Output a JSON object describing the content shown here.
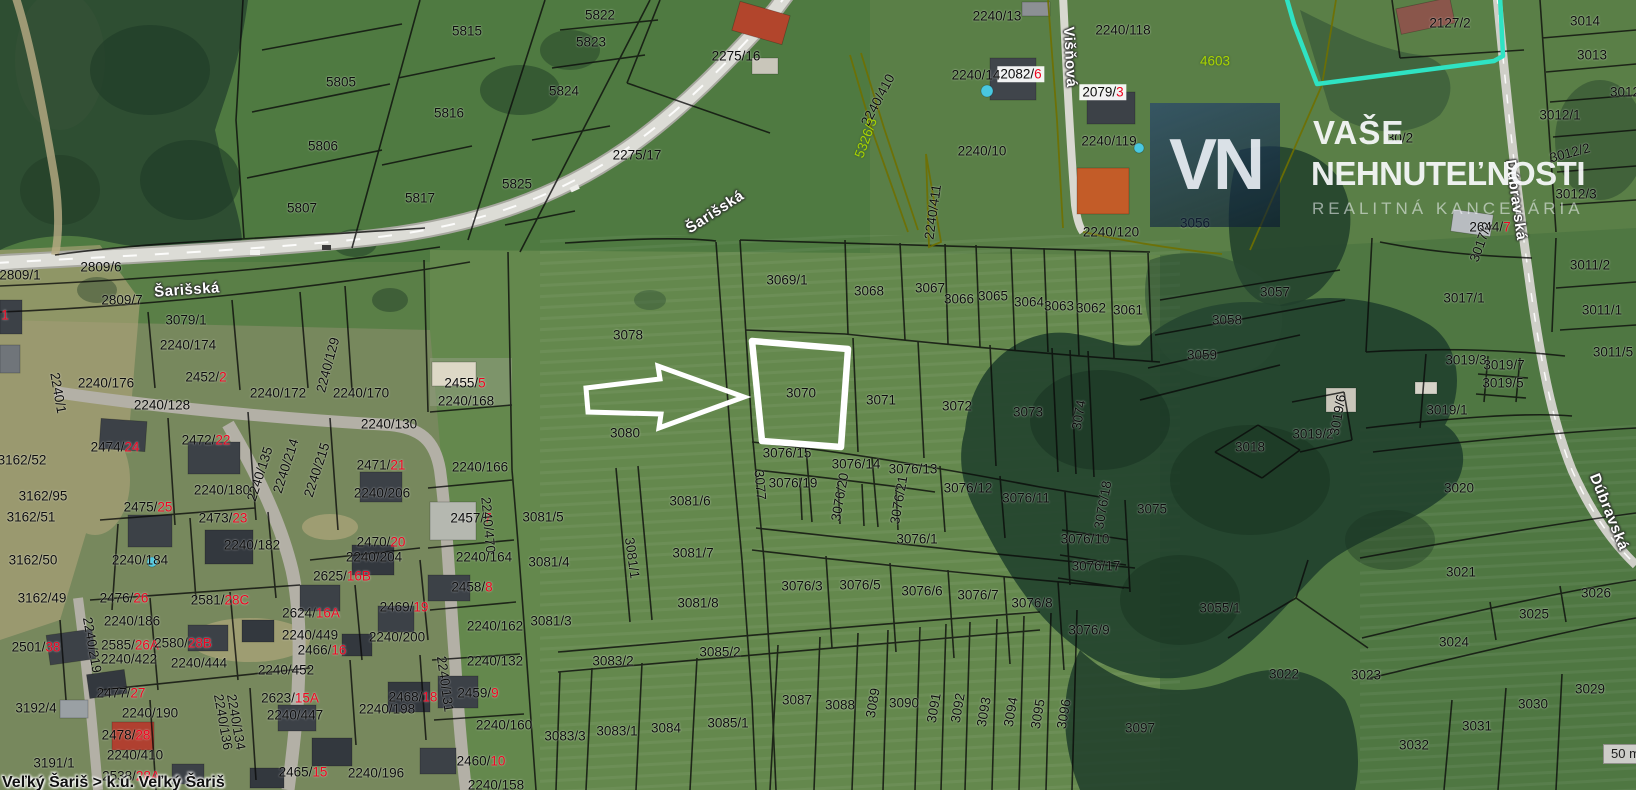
{
  "map": {
    "highlighted_parcel": "3070",
    "scale_label": "50 m",
    "status_text": "Veľký Šariš > k.ú. Veľký Šariš",
    "watermark": {
      "initials": "VN",
      "line1": "VAŠE",
      "line2": "NEHNUTEĽNOSTI",
      "line3": "REALITNÁ KANCELÁRIA"
    },
    "colors": {
      "red_suffix": "#ef0420",
      "yellow_label": "#a9d400",
      "cyan_boundary": "#2fe3c3",
      "highlight_outline": "#ffffff",
      "field_green": "#5a7f47"
    },
    "streets": [
      {
        "name": "Šarišská",
        "x": 715,
        "y": 212,
        "a": -33
      },
      {
        "name": "Šarišská",
        "x": 187,
        "y": 290,
        "a": -4
      },
      {
        "name": "Višňová",
        "x": 1070,
        "y": 57,
        "a": 87
      },
      {
        "name": "Dúbravská",
        "x": 1516,
        "y": 200,
        "a": 82
      },
      {
        "name": "Dúbravská",
        "x": 1609,
        "y": 512,
        "a": 68
      }
    ],
    "parcel_labels": [
      {
        "t": "5805",
        "x": 341,
        "y": 82
      },
      {
        "t": "5806",
        "x": 323,
        "y": 146
      },
      {
        "t": "5807",
        "x": 302,
        "y": 208
      },
      {
        "t": "5815",
        "x": 467,
        "y": 31
      },
      {
        "t": "5816",
        "x": 449,
        "y": 113
      },
      {
        "t": "5817",
        "x": 420,
        "y": 198
      },
      {
        "t": "5822",
        "x": 600,
        "y": 15
      },
      {
        "t": "5823",
        "x": 591,
        "y": 42
      },
      {
        "t": "5824",
        "x": 564,
        "y": 91
      },
      {
        "t": "5825",
        "x": 517,
        "y": 184
      },
      {
        "t": "2275/16",
        "x": 736,
        "y": 56
      },
      {
        "t": "2275/17",
        "x": 637,
        "y": 155
      },
      {
        "t": "2240/13",
        "x": 997,
        "y": 16
      },
      {
        "t": "2240/118",
        "x": 1123,
        "y": 30
      },
      {
        "t": "2082/",
        "r": "6",
        "x": 1021,
        "y": 74,
        "w": true
      },
      {
        "t": "2079/",
        "r": "3",
        "x": 1103,
        "y": 92,
        "w": true
      },
      {
        "t": "2240/14",
        "x": 976,
        "y": 75
      },
      {
        "t": "4603",
        "x": 1215,
        "y": 61,
        "c": "y"
      },
      {
        "t": "2240/119",
        "x": 1109,
        "y": 141
      },
      {
        "t": "2240/120",
        "x": 1111,
        "y": 232
      },
      {
        "t": "2240/10",
        "x": 982,
        "y": 151
      },
      {
        "t": "2240/410",
        "x": 878,
        "y": 100,
        "a": -62
      },
      {
        "t": "5326/3",
        "x": 866,
        "y": 138,
        "a": -70,
        "c": "y"
      },
      {
        "t": "2240/411",
        "x": 933,
        "y": 212,
        "a": -82
      },
      {
        "t": "2127/2",
        "x": 1450,
        "y": 23
      },
      {
        "t": "30/2",
        "x": 1400,
        "y": 138
      },
      {
        "t": "3014",
        "x": 1585,
        "y": 21
      },
      {
        "t": "3013",
        "x": 1592,
        "y": 55
      },
      {
        "t": "3012",
        "x": 1625,
        "y": 92
      },
      {
        "t": "3012/1",
        "x": 1560,
        "y": 115
      },
      {
        "t": "3012/2",
        "x": 1570,
        "y": 153,
        "a": -15
      },
      {
        "t": "3012/3",
        "x": 1576,
        "y": 194
      },
      {
        "t": "2644/",
        "r": "7",
        "x": 1490,
        "y": 227
      },
      {
        "t": "3056",
        "x": 1195,
        "y": 223
      },
      {
        "t": "3057",
        "x": 1275,
        "y": 292
      },
      {
        "t": "3058",
        "x": 1227,
        "y": 320
      },
      {
        "t": "3059",
        "x": 1202,
        "y": 355
      },
      {
        "t": "2809/6",
        "x": 101,
        "y": 267
      },
      {
        "t": "2809/1",
        "x": 20,
        "y": 275
      },
      {
        "t": "2809/7",
        "x": 122,
        "y": 300
      },
      {
        "t": "3079/1",
        "x": 186,
        "y": 320
      },
      {
        "t": "2240/174",
        "x": 188,
        "y": 345
      },
      {
        "t": "",
        "r": "1",
        "x": 5,
        "y": 315
      },
      {
        "t": "2452/",
        "r": "2",
        "x": 206,
        "y": 377
      },
      {
        "t": "2240/176",
        "x": 106,
        "y": 383
      },
      {
        "t": "2240/129",
        "x": 328,
        "y": 365,
        "a": -75
      },
      {
        "t": "2240/172",
        "x": 278,
        "y": 393
      },
      {
        "t": "2240/170",
        "x": 361,
        "y": 393
      },
      {
        "t": "2240/128",
        "x": 162,
        "y": 405
      },
      {
        "t": "2240/1",
        "x": 58,
        "y": 393,
        "a": 80
      },
      {
        "t": "2240/130",
        "x": 389,
        "y": 424
      },
      {
        "t": "2455/",
        "r": "5",
        "x": 465,
        "y": 383
      },
      {
        "t": "2240/168",
        "x": 466,
        "y": 401
      },
      {
        "t": "2240/166",
        "x": 480,
        "y": 467
      },
      {
        "t": "2471/",
        "r": "21",
        "x": 381,
        "y": 465
      },
      {
        "t": "2240/206",
        "x": 382,
        "y": 493
      },
      {
        "t": "2457/",
        "r": "7",
        "x": 471,
        "y": 518
      },
      {
        "t": "3081/5",
        "x": 543,
        "y": 517
      },
      {
        "t": "2240/470",
        "x": 488,
        "y": 525,
        "a": 85
      },
      {
        "t": "2470/",
        "r": "20",
        "x": 381,
        "y": 542
      },
      {
        "t": "2240/204",
        "x": 374,
        "y": 557
      },
      {
        "t": "2240/164",
        "x": 484,
        "y": 557
      },
      {
        "t": "3081/4",
        "x": 549,
        "y": 562
      },
      {
        "t": "2625/",
        "r": "16B",
        "x": 342,
        "y": 576
      },
      {
        "t": "2474/",
        "r": "24",
        "x": 115,
        "y": 447
      },
      {
        "t": "2472/",
        "r": "22",
        "x": 206,
        "y": 440
      },
      {
        "t": "3162/52",
        "x": 22,
        "y": 460
      },
      {
        "t": "3162/95",
        "x": 43,
        "y": 496
      },
      {
        "t": "3162/51",
        "x": 31,
        "y": 517
      },
      {
        "t": "2240/180",
        "x": 222,
        "y": 490
      },
      {
        "t": "2240/135",
        "x": 260,
        "y": 474,
        "a": -72
      },
      {
        "t": "2240/214",
        "x": 286,
        "y": 466,
        "a": -72
      },
      {
        "t": "2240/215",
        "x": 317,
        "y": 470,
        "a": -72
      },
      {
        "t": "2475/",
        "r": "25",
        "x": 148,
        "y": 507
      },
      {
        "t": "2473/",
        "r": "23",
        "x": 223,
        "y": 518
      },
      {
        "t": "2240/182",
        "x": 252,
        "y": 545
      },
      {
        "t": "3162/50",
        "x": 33,
        "y": 560
      },
      {
        "t": "2240/184",
        "x": 140,
        "y": 560
      },
      {
        "t": "3162/49",
        "x": 42,
        "y": 598
      },
      {
        "t": "2476/",
        "r": "26",
        "x": 124,
        "y": 598
      },
      {
        "t": "2581/",
        "r": "28C",
        "x": 220,
        "y": 600
      },
      {
        "t": "2624/",
        "r": "16A",
        "x": 311,
        "y": 613
      },
      {
        "t": "2240/186",
        "x": 132,
        "y": 621
      },
      {
        "t": "2501/",
        "r": "38",
        "x": 36,
        "y": 647
      },
      {
        "t": "2585/",
        "r": "26A",
        "x": 130,
        "y": 645
      },
      {
        "t": "2580/",
        "r": "28B",
        "x": 183,
        "y": 643
      },
      {
        "t": "2240/422",
        "x": 129,
        "y": 659
      },
      {
        "t": "2240/444",
        "x": 199,
        "y": 663
      },
      {
        "t": "2240/449",
        "x": 310,
        "y": 635
      },
      {
        "t": "2466/",
        "r": "16",
        "x": 322,
        "y": 650
      },
      {
        "t": "2240/452",
        "x": 286,
        "y": 670
      },
      {
        "t": "2240/219",
        "x": 92,
        "y": 645,
        "a": 80
      },
      {
        "t": "2477/",
        "r": "27",
        "x": 121,
        "y": 693
      },
      {
        "t": "3192/4",
        "x": 36,
        "y": 708
      },
      {
        "t": "2240/190",
        "x": 150,
        "y": 713
      },
      {
        "t": "2623/",
        "r": "15A",
        "x": 290,
        "y": 698
      },
      {
        "t": "2240/447",
        "x": 295,
        "y": 715
      },
      {
        "t": "2478/",
        "r": "28",
        "x": 126,
        "y": 735
      },
      {
        "t": "2240/410",
        "x": 135,
        "y": 755
      },
      {
        "t": "2240/136",
        "x": 223,
        "y": 722,
        "a": 80
      },
      {
        "t": "2240/134",
        "x": 236,
        "y": 722,
        "a": 80
      },
      {
        "t": "3191/1",
        "x": 54,
        "y": 763
      },
      {
        "t": "2538/",
        "r": "28A",
        "x": 131,
        "y": 776
      },
      {
        "t": "2465/",
        "r": "15",
        "x": 303,
        "y": 772
      },
      {
        "t": "2240/196",
        "x": 376,
        "y": 773
      },
      {
        "t": "2240/198",
        "x": 387,
        "y": 709
      },
      {
        "t": "2468/",
        "r": "18",
        "x": 413,
        "y": 697
      },
      {
        "t": "2459/",
        "r": "9",
        "x": 478,
        "y": 693
      },
      {
        "t": "2240/160",
        "x": 504,
        "y": 725
      },
      {
        "t": "2460/",
        "r": "10",
        "x": 481,
        "y": 761
      },
      {
        "t": "2240/158",
        "x": 496,
        "y": 785
      },
      {
        "t": "2240/200",
        "x": 397,
        "y": 637
      },
      {
        "t": "2469/",
        "r": "19",
        "x": 404,
        "y": 607
      },
      {
        "t": "2458/",
        "r": "8",
        "x": 472,
        "y": 587
      },
      {
        "t": "2240/162",
        "x": 495,
        "y": 626
      },
      {
        "t": "2240/132",
        "x": 495,
        "y": 661
      },
      {
        "t": "2240/131",
        "x": 445,
        "y": 684,
        "a": 82
      },
      {
        "t": "3081/3",
        "x": 551,
        "y": 621
      },
      {
        "t": "3083/3",
        "x": 565,
        "y": 736
      },
      {
        "t": "3083/1",
        "x": 617,
        "y": 731
      },
      {
        "t": "3084",
        "x": 666,
        "y": 728
      },
      {
        "t": "3085/1",
        "x": 728,
        "y": 723
      },
      {
        "t": "3083/2",
        "x": 613,
        "y": 661
      },
      {
        "t": "3085/2",
        "x": 720,
        "y": 652
      },
      {
        "t": "3081/8",
        "x": 698,
        "y": 603
      },
      {
        "t": "3081/7",
        "x": 693,
        "y": 553
      },
      {
        "t": "3081/6",
        "x": 690,
        "y": 501
      },
      {
        "t": "3081/1",
        "x": 632,
        "y": 558,
        "a": 82
      },
      {
        "t": "3080",
        "x": 625,
        "y": 433
      },
      {
        "t": "3078",
        "x": 628,
        "y": 335
      },
      {
        "t": "3077",
        "x": 760,
        "y": 485,
        "a": 85
      },
      {
        "t": "3069/1",
        "x": 787,
        "y": 280
      },
      {
        "t": "3068",
        "x": 869,
        "y": 291
      },
      {
        "t": "3067",
        "x": 930,
        "y": 288
      },
      {
        "t": "3066",
        "x": 959,
        "y": 299
      },
      {
        "t": "3065",
        "x": 993,
        "y": 296
      },
      {
        "t": "3064",
        "x": 1029,
        "y": 302
      },
      {
        "t": "3063",
        "x": 1059,
        "y": 306
      },
      {
        "t": "3062",
        "x": 1091,
        "y": 308
      },
      {
        "t": "3061",
        "x": 1128,
        "y": 310
      },
      {
        "t": "3070",
        "x": 801,
        "y": 393
      },
      {
        "t": "3071",
        "x": 881,
        "y": 400
      },
      {
        "t": "3072",
        "x": 957,
        "y": 406
      },
      {
        "t": "3073",
        "x": 1028,
        "y": 412
      },
      {
        "t": "3074",
        "x": 1079,
        "y": 415,
        "a": -80
      },
      {
        "t": "3076/15",
        "x": 787,
        "y": 453
      },
      {
        "t": "3076/14",
        "x": 856,
        "y": 464
      },
      {
        "t": "3076/13",
        "x": 913,
        "y": 469
      },
      {
        "t": "3076/12",
        "x": 968,
        "y": 488
      },
      {
        "t": "3076/11",
        "x": 1026,
        "y": 498
      },
      {
        "t": "3076/19",
        "x": 793,
        "y": 483
      },
      {
        "t": "3076/20",
        "x": 840,
        "y": 497,
        "a": -80
      },
      {
        "t": "3076/21",
        "x": 899,
        "y": 500,
        "a": -80
      },
      {
        "t": "3076/1",
        "x": 917,
        "y": 539
      },
      {
        "t": "3076/3",
        "x": 802,
        "y": 586
      },
      {
        "t": "3076/5",
        "x": 860,
        "y": 585
      },
      {
        "t": "3076/6",
        "x": 922,
        "y": 591
      },
      {
        "t": "3076/7",
        "x": 978,
        "y": 595
      },
      {
        "t": "3076/8",
        "x": 1032,
        "y": 603
      },
      {
        "t": "3076/9",
        "x": 1089,
        "y": 630
      },
      {
        "t": "3076/10",
        "x": 1085,
        "y": 539
      },
      {
        "t": "3076/17",
        "x": 1096,
        "y": 566
      },
      {
        "t": "3076/18",
        "x": 1103,
        "y": 505,
        "a": -80
      },
      {
        "t": "3075",
        "x": 1152,
        "y": 509
      },
      {
        "t": "3055/1",
        "x": 1220,
        "y": 608
      },
      {
        "t": "3087",
        "x": 797,
        "y": 700
      },
      {
        "t": "3088",
        "x": 840,
        "y": 705
      },
      {
        "t": "3089",
        "x": 873,
        "y": 703,
        "a": -80
      },
      {
        "t": "3090",
        "x": 904,
        "y": 703
      },
      {
        "t": "3091",
        "x": 934,
        "y": 708,
        "a": -80
      },
      {
        "t": "3092",
        "x": 958,
        "y": 708,
        "a": -80
      },
      {
        "t": "3093",
        "x": 984,
        "y": 712,
        "a": -80
      },
      {
        "t": "3094",
        "x": 1011,
        "y": 712,
        "a": -80
      },
      {
        "t": "3095",
        "x": 1038,
        "y": 714,
        "a": -80
      },
      {
        "t": "3096",
        "x": 1064,
        "y": 714,
        "a": -80
      },
      {
        "t": "3097",
        "x": 1140,
        "y": 728
      },
      {
        "t": "3022",
        "x": 1284,
        "y": 674
      },
      {
        "t": "3018",
        "x": 1250,
        "y": 447
      },
      {
        "t": "3019/2",
        "x": 1313,
        "y": 434
      },
      {
        "t": "3019/6",
        "x": 1338,
        "y": 415,
        "a": -80
      },
      {
        "t": "3019/3",
        "x": 1466,
        "y": 360
      },
      {
        "t": "3019/7",
        "x": 1504,
        "y": 365
      },
      {
        "t": "3019/5",
        "x": 1503,
        "y": 383
      },
      {
        "t": "3019/1",
        "x": 1447,
        "y": 410
      },
      {
        "t": "3017/1",
        "x": 1464,
        "y": 298
      },
      {
        "t": "3017/2",
        "x": 1481,
        "y": 242,
        "a": -70
      },
      {
        "t": "3011/2",
        "x": 1590,
        "y": 265
      },
      {
        "t": "3011/1",
        "x": 1602,
        "y": 310
      },
      {
        "t": "3011/5",
        "x": 1613,
        "y": 352
      },
      {
        "t": "3020",
        "x": 1459,
        "y": 488
      },
      {
        "t": "3021",
        "x": 1461,
        "y": 572
      },
      {
        "t": "3026",
        "x": 1596,
        "y": 593
      },
      {
        "t": "3025",
        "x": 1534,
        "y": 614
      },
      {
        "t": "3024",
        "x": 1454,
        "y": 642
      },
      {
        "t": "3023",
        "x": 1366,
        "y": 675
      },
      {
        "t": "3029",
        "x": 1590,
        "y": 689
      },
      {
        "t": "3030",
        "x": 1533,
        "y": 704
      },
      {
        "t": "3031",
        "x": 1477,
        "y": 726
      },
      {
        "t": "3032",
        "x": 1414,
        "y": 745
      }
    ]
  }
}
